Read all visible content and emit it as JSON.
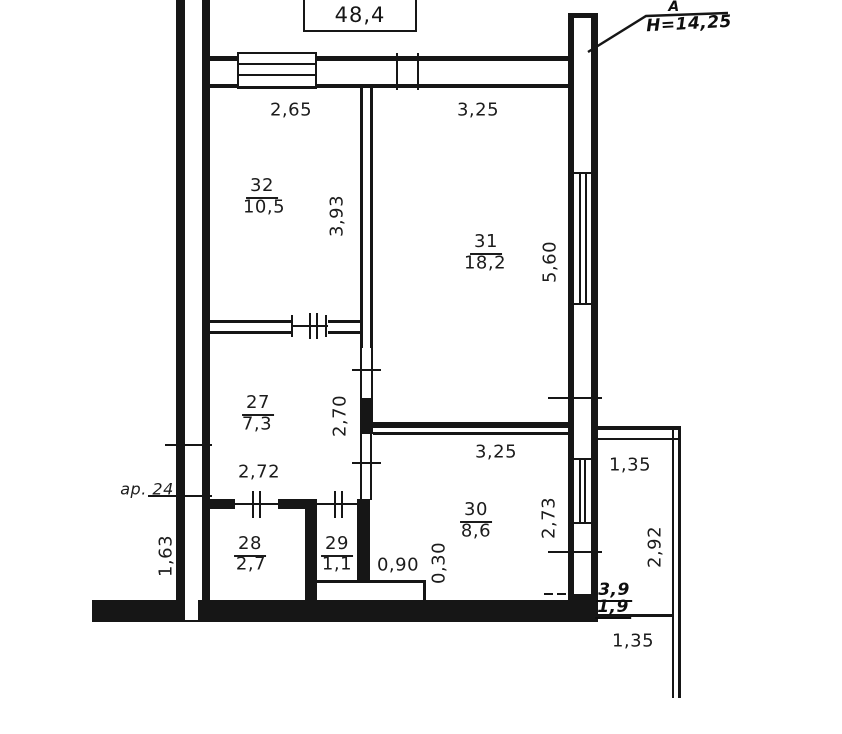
{
  "colors": {
    "line": "#161616",
    "background": "#ffffff"
  },
  "header": {
    "total_area": "48,4",
    "section_letter": "A",
    "height_note": "H=14,25"
  },
  "apartment_note": "ap. 24",
  "rooms": [
    {
      "number": "32",
      "area": "10,5"
    },
    {
      "number": "31",
      "area": "18,2"
    },
    {
      "number": "27",
      "area": "7,3"
    },
    {
      "number": "30",
      "area": "8,6"
    },
    {
      "number": "28",
      "area": "2,7"
    },
    {
      "number": "29",
      "area": "1,1"
    }
  ],
  "dimensions": {
    "room32_width": "2,65",
    "room31_width": "3,25",
    "room32_depth": "3,93",
    "room31_depth": "5,60",
    "room27_depth": "2,70",
    "room27_width": "2,72",
    "room30_width": "3,25",
    "room30_depth": "2,73",
    "niche_width": "0,90",
    "niche_depth": "0,30",
    "entry_wall": "1,63",
    "balcony_width": "1,35",
    "balcony_depth": "2,92",
    "balcony_area_full": "3,9",
    "balcony_area_reduced": "1,9",
    "balcony_width_bottom": "1,35"
  }
}
